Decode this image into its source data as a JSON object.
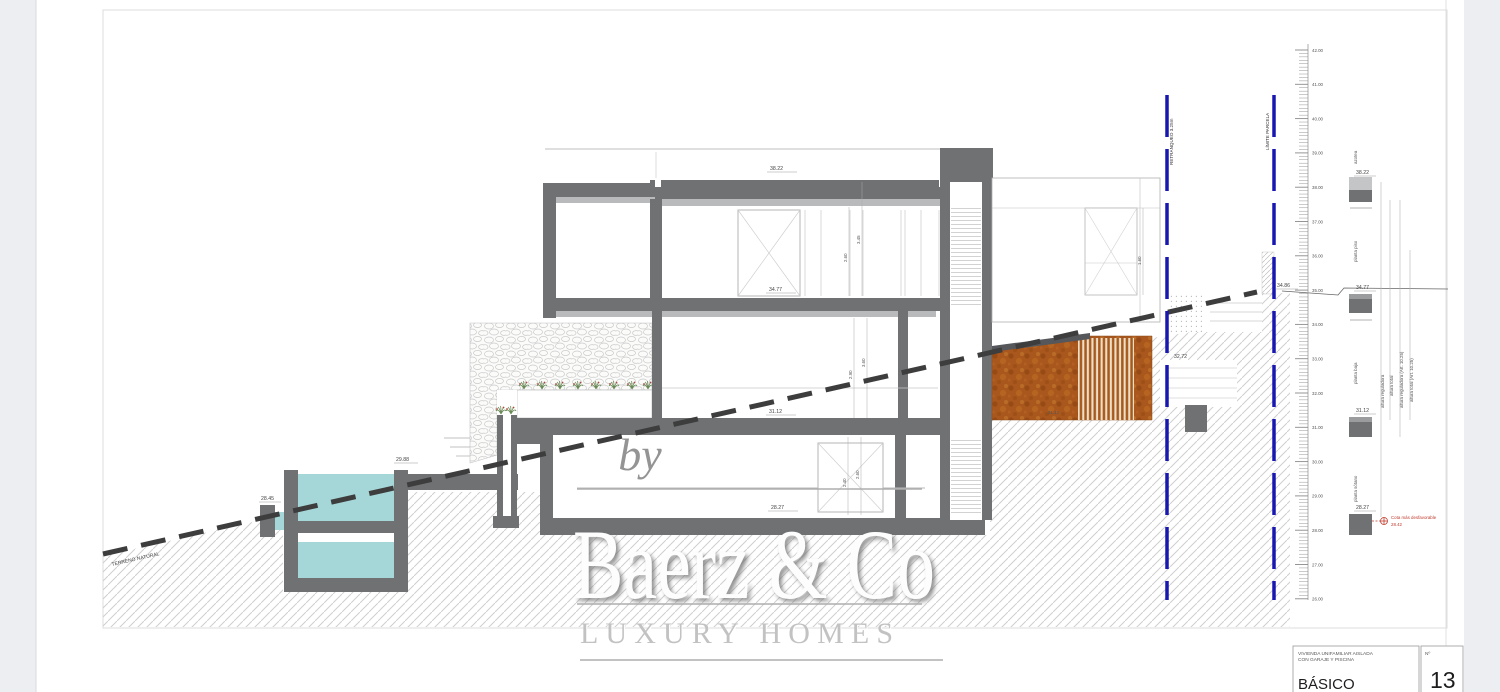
{
  "page": {
    "background": "#edeef2",
    "paper": "#ffffff",
    "frame_border": "#dcdcdc"
  },
  "colors": {
    "wall": "#6f7173",
    "wall_light": "#b9babc",
    "water": "#a6d7d8",
    "corten": "#a9571c",
    "parcel_blue": "#1818b0",
    "terrain": "#3d3d3d",
    "annotation_red": "#c0392b",
    "hatch_line": "#cfcfcf"
  },
  "watermark": {
    "by": "by",
    "brand": "Baerz & Co",
    "tagline": "LUXURY HOMES"
  },
  "boundaries": {
    "setback": "RETRANQUEO 3.25m",
    "parcel": "LÍMITE PARCELA",
    "terrain": "TERRENO NATURAL"
  },
  "floor_labels": {
    "roof": "azotea",
    "upper": "planta piso",
    "ground": "planta baja",
    "basement": "planta sótano"
  },
  "elevations": {
    "roof": "38.22",
    "upper": "34.77",
    "ground": "31.12",
    "basement": "28.27",
    "pool_top": "29.88",
    "pool_low": "28.45",
    "terrace": "32.72",
    "street": "34.86",
    "corten": "31.12",
    "worst_label": "Cota más desfavorable",
    "worst": "28.42"
  },
  "floor_heights": {
    "upper_clear": "2.60",
    "upper_total": "3.45",
    "ground_clear": "2.90",
    "ground_total": "3.60",
    "basement_clear": "2.40",
    "basement_total": "2.60",
    "wing": "1.60"
  },
  "height_lines": {
    "reg": "altura reguladora",
    "total": "altura total",
    "reg_art": "altura reguladora (Art. 10.25)",
    "total_art": "altura total (Art. 10.25)"
  },
  "ruler": {
    "max": 42,
    "min": 26,
    "max_y": 50,
    "px_per_unit": 34.3
  },
  "title_block": {
    "project_line1": "VIVIENDA UNIFAMILIAR AISLADA",
    "project_line2": "CON GARAJE Y PISCINA",
    "phase": "BÁSICO",
    "number_label": "Nº",
    "number": "13"
  }
}
